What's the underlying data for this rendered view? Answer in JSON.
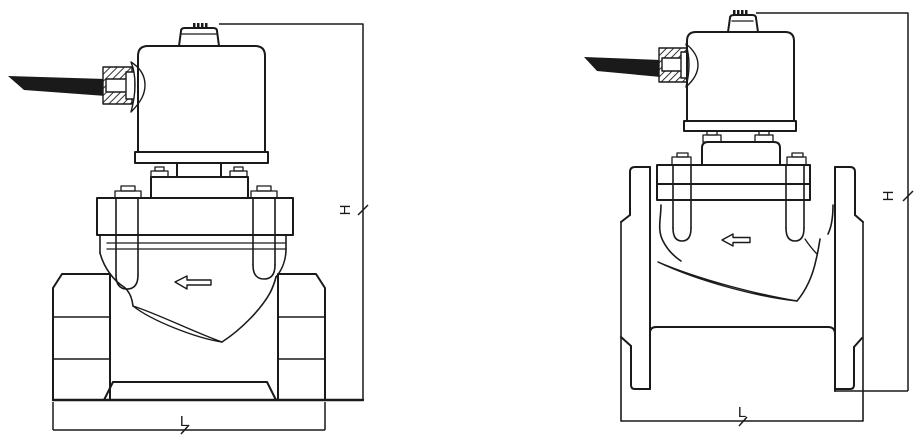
{
  "page": {
    "background": "#ffffff",
    "line_color": "#1a1a1a"
  },
  "figures": {
    "threaded": {
      "name": "solenoid-valve-threaded-ports",
      "dimensions": {
        "height_label": "H",
        "length_label": "L"
      },
      "flow_arrow_direction": "left"
    },
    "flanged": {
      "name": "solenoid-valve-flanged-ports",
      "dimensions": {
        "height_label": "H",
        "length_label": "L"
      },
      "flow_arrow_direction": "left"
    }
  }
}
